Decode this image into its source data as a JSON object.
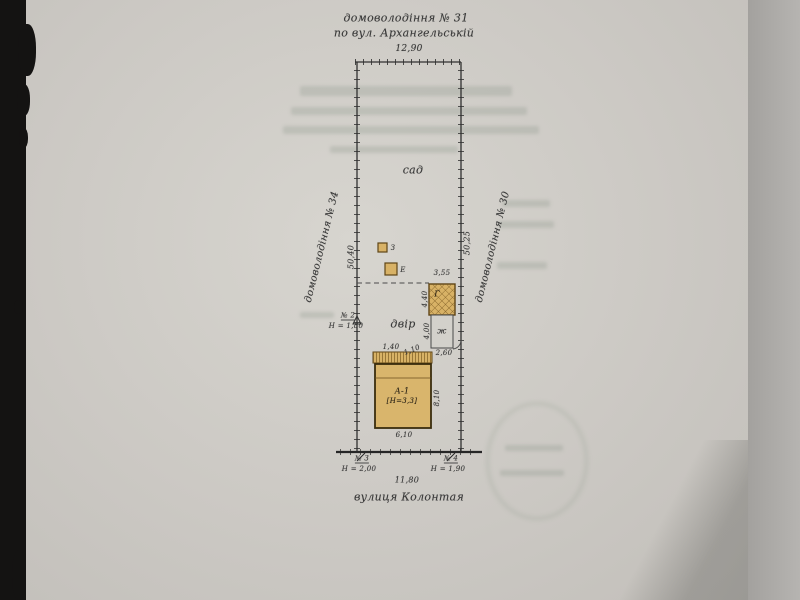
{
  "plan": {
    "top": {
      "estate": "домоволодіння № 31",
      "street_ref": "по вул. Архангельській",
      "width": "12,90"
    },
    "left": {
      "estate": "домоволодіння № 34",
      "length": "50,40",
      "marker_no": "№ 2",
      "marker_h": "Н = 1,80"
    },
    "right": {
      "estate": "домоволодіння № 30",
      "length": "50,25"
    },
    "areas": {
      "garden": "сад",
      "yard": "двір"
    },
    "buildings": {
      "shed1": "З",
      "shed2": "Е",
      "garage": "Г",
      "garage_width": "3,55",
      "garage_depth": "4,40",
      "zh": "ж",
      "zh_depth": "4,00",
      "zh_width": "2,60",
      "house": "А-1",
      "house_note": "[Н=3,3]",
      "house_width": "6,10",
      "house_depth": "8,10",
      "porch_dim1": "1,40",
      "porch_dim2": "1,10"
    },
    "bottom": {
      "marker3_no": "№ 3",
      "marker3_h": "Н = 2,00",
      "marker4_no": "№ 4",
      "marker4_h": "Н = 1,90",
      "frontage": "11,80",
      "street": "вулиця Колонтая"
    }
  },
  "colors": {
    "building_fill": "#d8b266",
    "building_stroke": "#5f4516",
    "line": "#303030",
    "paper": "#cdcac5"
  }
}
